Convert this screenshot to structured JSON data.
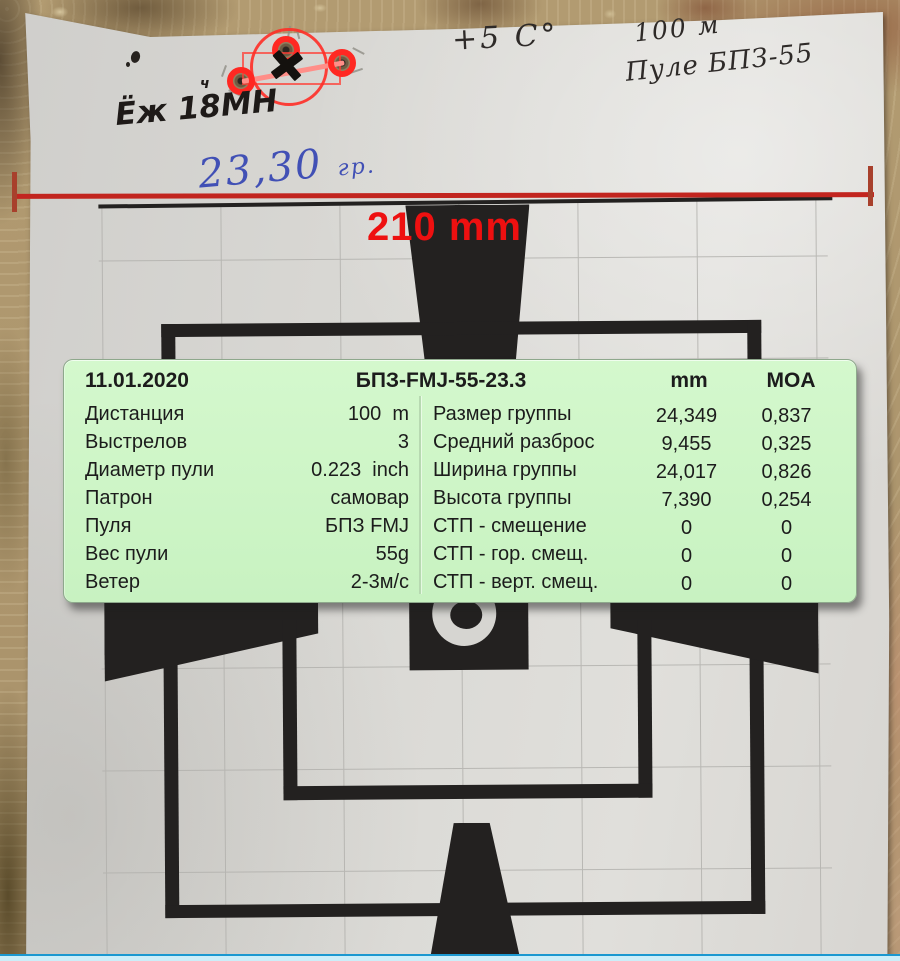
{
  "panel": {
    "date": "11.01.2020",
    "title": "БПЗ-FMJ-55-23.3",
    "col_mm": "mm",
    "col_moa": "MOA",
    "info_rows": [
      {
        "label": "Дистанция",
        "value": "100  m"
      },
      {
        "label": "Выстрелов",
        "value": "3"
      },
      {
        "label": "Диаметр пули",
        "value": "0.223  inch"
      },
      {
        "label": "Патрон",
        "value": "самовар"
      },
      {
        "label": "Пуля",
        "value": "БПЗ FMJ"
      },
      {
        "label": "Вес пули",
        "value": "55g"
      },
      {
        "label": "Ветер",
        "value": "2-3м/с"
      }
    ],
    "stat_rows": [
      {
        "label": "Размер группы",
        "mm": "24,349",
        "moa": "0,837"
      },
      {
        "label": "Средний разброс",
        "mm": "9,455",
        "moa": "0,325"
      },
      {
        "label": "Ширина группы",
        "mm": "24,017",
        "moa": "0,826"
      },
      {
        "label": "Высота группы",
        "mm": "7,390",
        "moa": "0,254"
      },
      {
        "label": "СТП - смещение",
        "mm": "0",
        "moa": "0"
      },
      {
        "label": "СТП - гор. смещ.",
        "mm": "0",
        "moa": "0"
      },
      {
        "label": "СТП - верт. смещ.",
        "mm": "0",
        "moa": "0"
      }
    ]
  },
  "annotations": {
    "width_label": "210 mm",
    "group_weight": "23,30",
    "group_weight_unit": "гр.",
    "temperature": "+5 C°",
    "distance": "100 м",
    "bullet": "Пуле БПЗ-55",
    "rifle": "Ёж 18МН",
    "rifle_mark": "ч"
  },
  "colors": {
    "panel_bg": "#cdf4c7",
    "accent_red": "#ee1010",
    "marker_red": "#ff2822",
    "measure_red": "#c2251f",
    "handwriting_blue": "#4150b5",
    "taskbar_blue": "#cceef9",
    "print_black": "#232120"
  }
}
